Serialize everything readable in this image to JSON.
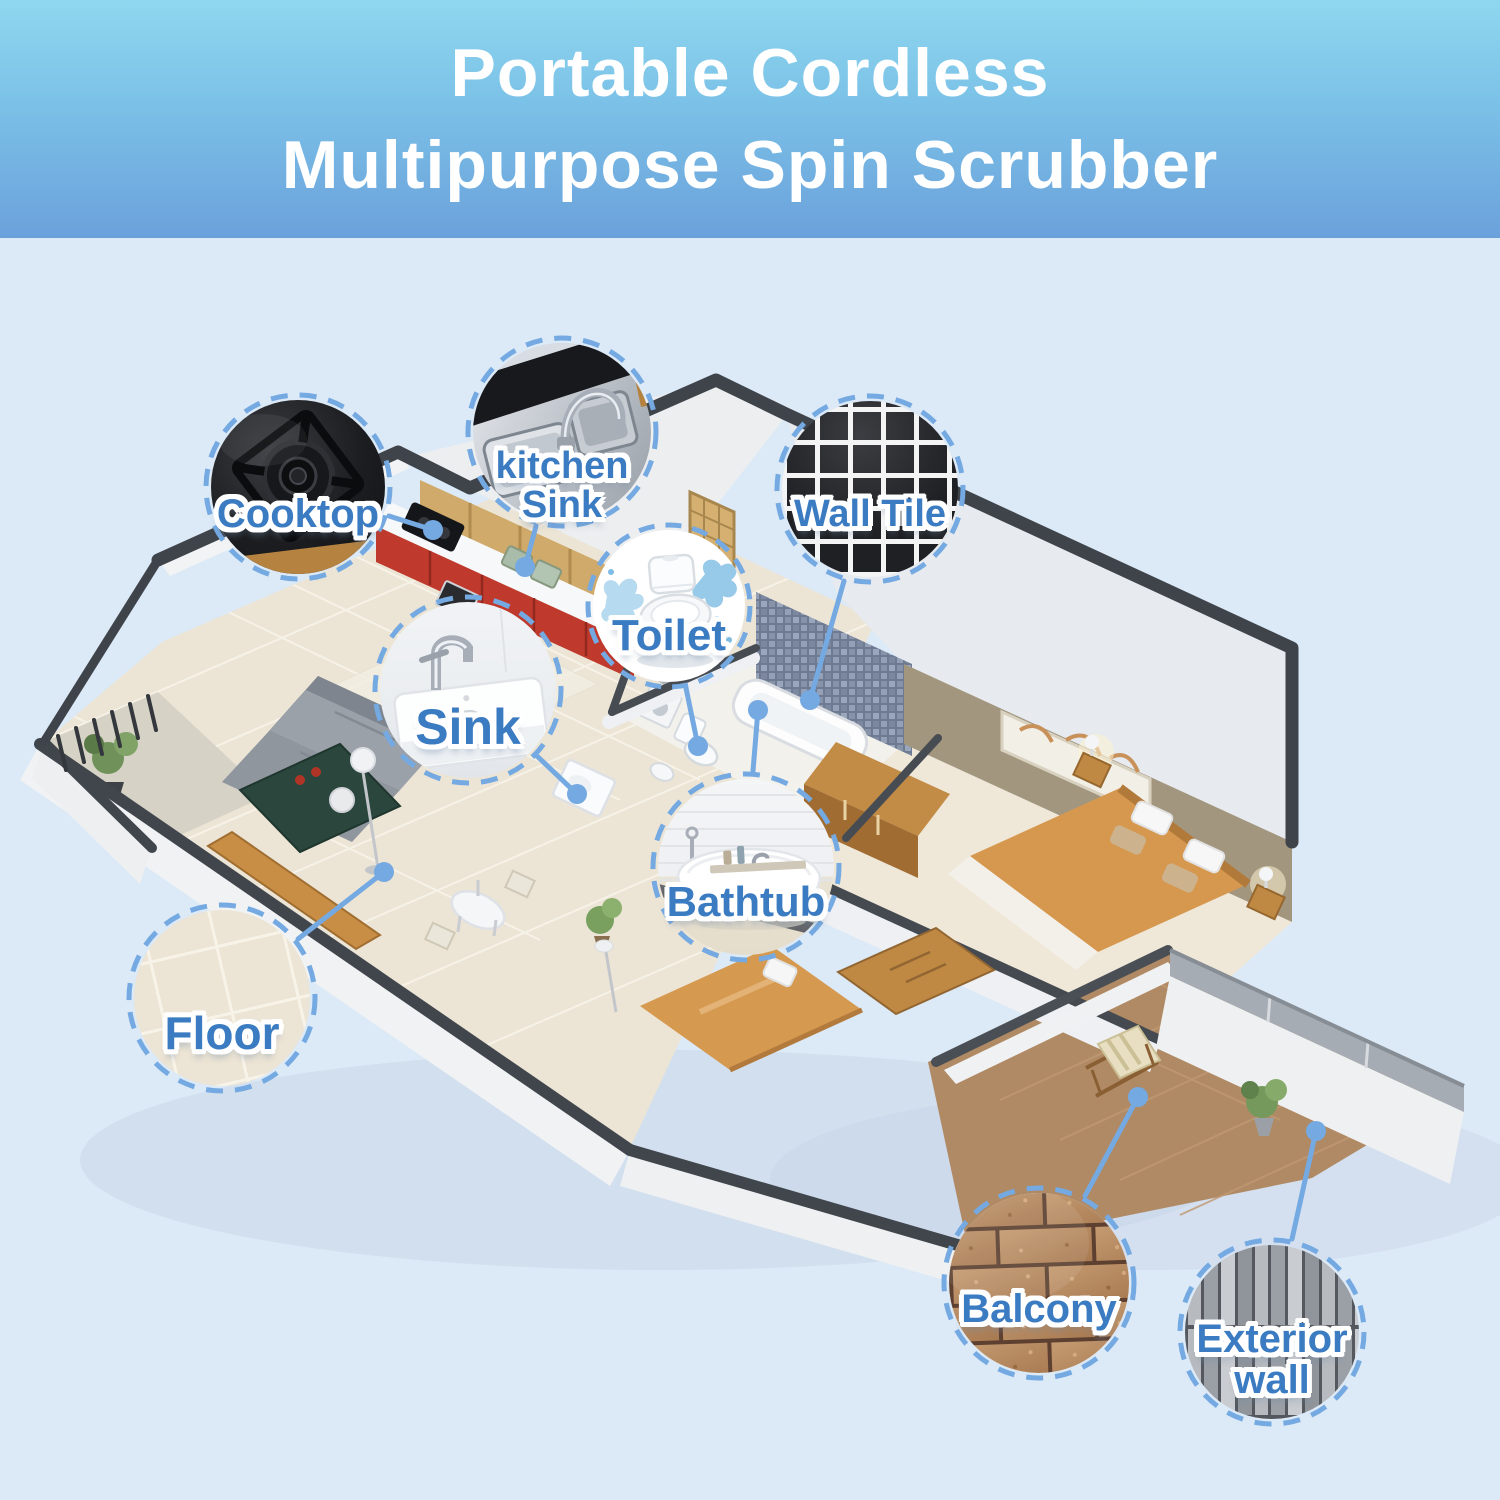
{
  "header": {
    "title_lines": [
      "Portable Cordless",
      "Multipurpose Spin Scrubber"
    ]
  },
  "callouts": {
    "cooktop": {
      "label": "Cooktop"
    },
    "kitchen_sink": {
      "label_line1": "kitchen",
      "label_line2": "Sink"
    },
    "wall_tile": {
      "label": "Wall Tile"
    },
    "toilet": {
      "label": "Toilet"
    },
    "sink": {
      "label": "Sink"
    },
    "bathtub": {
      "label": "Bathtub"
    },
    "floor": {
      "label": "Floor"
    },
    "balcony": {
      "label": "Balcony"
    },
    "exterior_wall": {
      "label_line1": "Exterior",
      "label_line2": "wall"
    }
  },
  "colors": {
    "accent_blue": "#74a9e2",
    "label_blue": "#3a7bc2",
    "header_gradient_top": "#8fd7ef",
    "header_gradient_bottom": "#6ba1db",
    "background": "#dce9f6"
  }
}
